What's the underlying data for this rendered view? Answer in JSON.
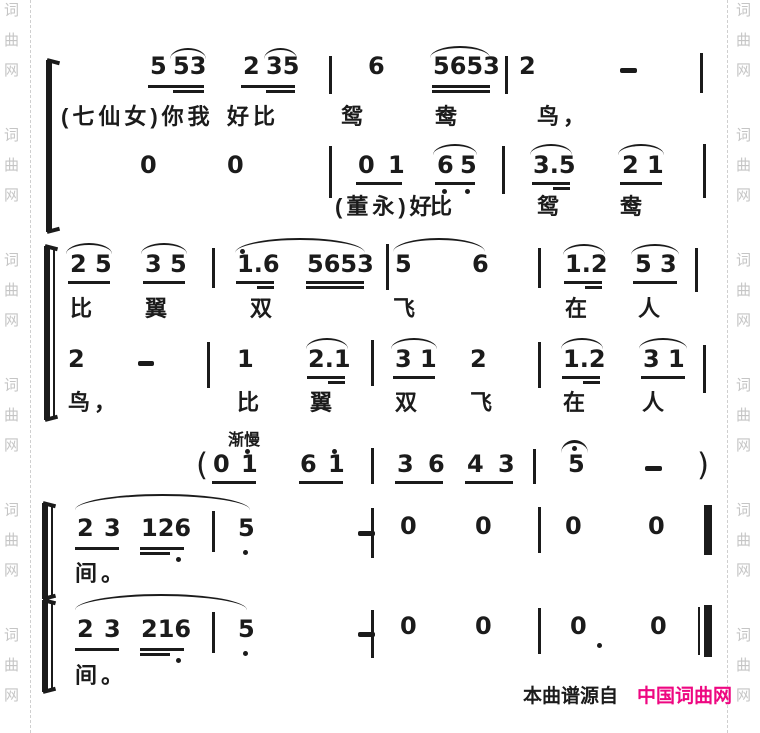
{
  "page": {
    "width": 760,
    "height": 733,
    "bg": "#ffffff",
    "ink": "#1b1b1b"
  },
  "watermark": {
    "chars": [
      "词",
      "曲",
      "网"
    ],
    "color": "#c5c5c5",
    "group_ys": [
      3,
      128,
      253,
      378,
      503,
      628
    ],
    "char_gap": 30,
    "left_x": 4,
    "right_x": 736,
    "divider_left_x": 30,
    "divider_right_x": 727
  },
  "credit": {
    "prefix": "本曲谱源自",
    "brand": "中国词曲网",
    "prefix_color": "#1b1b1b",
    "brand_color": "#ee0781",
    "prefix_x": 523,
    "brand_x": 637,
    "y": 686
  },
  "score": {
    "summary": [
      "5 53 2 35 | 6 5653 | 2 — |  (七仙女)你我好比鸳鸯鸟，",
      "0 0 | 01 65 | 3.5 21 |  (董永)好比鸳鸯",
      "25 35 | 1.6 5653 | 5 6 | 1.2 53 |  比翼双飞在人",
      "2 — | 1 2.1 | 31 2 | 1.2 31 |  鸟，比翼双飞在人",
      "渐慢 (01 61 | 36 43 | 5 — )",
      "23 126 | 5 — | 0 0 | 0 0 ‖  间。",
      "23 216 | 5 — | 0 0 | 0 0 ‖  间。"
    ],
    "elements": [
      {
        "t": "brace",
        "x": 46,
        "y": 60,
        "h": 172
      },
      {
        "t": "brace",
        "x": 44,
        "y": 246,
        "h": 174
      },
      {
        "t": "bar",
        "x": 53,
        "y": 248,
        "h": 170,
        "w": 2
      },
      {
        "t": "brace",
        "x": 42,
        "y": 503,
        "h": 96
      },
      {
        "t": "bar",
        "x": 51,
        "y": 505,
        "h": 92,
        "w": 2
      },
      {
        "t": "brace",
        "x": 42,
        "y": 600,
        "h": 92
      },
      {
        "t": "bar",
        "x": 51,
        "y": 602,
        "h": 88,
        "w": 2
      },
      {
        "t": "note",
        "x": 150,
        "y": 58,
        "text": "5"
      },
      {
        "t": "note",
        "x": 173,
        "y": 58,
        "text": "53"
      },
      {
        "t": "beam",
        "x": 148,
        "y": 85,
        "w": 56
      },
      {
        "t": "beam",
        "x": 173,
        "y": 90,
        "w": 31
      },
      {
        "t": "slur",
        "x": 170,
        "y": 48,
        "w": 36
      },
      {
        "t": "note",
        "x": 243,
        "y": 58,
        "text": "2"
      },
      {
        "t": "note",
        "x": 266,
        "y": 58,
        "text": "35"
      },
      {
        "t": "beam",
        "x": 241,
        "y": 85,
        "w": 54
      },
      {
        "t": "beam",
        "x": 266,
        "y": 90,
        "w": 29
      },
      {
        "t": "slur",
        "x": 264,
        "y": 48,
        "w": 33
      },
      {
        "t": "bar",
        "x": 329,
        "y": 56,
        "h": 38
      },
      {
        "t": "note",
        "x": 368,
        "y": 58,
        "text": "6"
      },
      {
        "t": "note",
        "x": 433,
        "y": 58,
        "text": "5653"
      },
      {
        "t": "beam",
        "x": 432,
        "y": 85,
        "w": 58
      },
      {
        "t": "beam",
        "x": 432,
        "y": 90,
        "w": 58
      },
      {
        "t": "slur",
        "x": 430,
        "y": 46,
        "w": 60,
        "h": 12
      },
      {
        "t": "bar",
        "x": 505,
        "y": 56,
        "h": 38
      },
      {
        "t": "note",
        "x": 519,
        "y": 58,
        "text": "2"
      },
      {
        "t": "dash",
        "x": 620,
        "y": 68,
        "w": 17
      },
      {
        "t": "bar",
        "x": 700,
        "y": 53,
        "h": 40
      },
      {
        "t": "lyric",
        "x": 61,
        "y": 105,
        "text": "(七仙女)你我"
      },
      {
        "t": "lyric",
        "x": 227,
        "y": 105,
        "text": "好比"
      },
      {
        "t": "lyric",
        "x": 341,
        "y": 105,
        "text": "鸳"
      },
      {
        "t": "lyric",
        "x": 435,
        "y": 105,
        "text": "鸯"
      },
      {
        "t": "lyric",
        "x": 537,
        "y": 105,
        "text": "鸟，"
      },
      {
        "t": "note",
        "x": 140,
        "y": 157,
        "text": "0"
      },
      {
        "t": "note",
        "x": 227,
        "y": 157,
        "text": "0"
      },
      {
        "t": "bar",
        "x": 329,
        "y": 146,
        "h": 52
      },
      {
        "t": "note",
        "x": 358,
        "y": 157,
        "text": "0"
      },
      {
        "t": "note",
        "x": 388,
        "y": 157,
        "text": "1"
      },
      {
        "t": "beam",
        "x": 356,
        "y": 182,
        "w": 46
      },
      {
        "t": "note",
        "x": 437,
        "y": 157,
        "text": "6"
      },
      {
        "t": "note",
        "x": 460,
        "y": 157,
        "text": "5"
      },
      {
        "t": "beam",
        "x": 435,
        "y": 182,
        "w": 40
      },
      {
        "t": "slur",
        "x": 433,
        "y": 144,
        "w": 44
      },
      {
        "t": "dot",
        "x": 442,
        "y": 189
      },
      {
        "t": "dot",
        "x": 465,
        "y": 189
      },
      {
        "t": "bar",
        "x": 502,
        "y": 146,
        "h": 48
      },
      {
        "t": "note",
        "x": 533,
        "y": 157,
        "text": "3.5"
      },
      {
        "t": "beam",
        "x": 532,
        "y": 182,
        "w": 38
      },
      {
        "t": "beam",
        "x": 553,
        "y": 187,
        "w": 17
      },
      {
        "t": "slur",
        "x": 530,
        "y": 144,
        "w": 42
      },
      {
        "t": "note",
        "x": 622,
        "y": 157,
        "text": "2"
      },
      {
        "t": "note",
        "x": 647,
        "y": 157,
        "text": "1"
      },
      {
        "t": "beam",
        "x": 620,
        "y": 182,
        "w": 42
      },
      {
        "t": "slur",
        "x": 618,
        "y": 144,
        "w": 46
      },
      {
        "t": "bar",
        "x": 703,
        "y": 144,
        "h": 54
      },
      {
        "t": "lyric",
        "x": 335,
        "y": 195,
        "text": "(董永)好"
      },
      {
        "t": "lyric",
        "x": 430,
        "y": 195,
        "text": "比"
      },
      {
        "t": "lyric",
        "x": 537,
        "y": 195,
        "text": "鸳"
      },
      {
        "t": "lyric",
        "x": 620,
        "y": 195,
        "text": "鸯"
      },
      {
        "t": "note",
        "x": 70,
        "y": 256,
        "text": "2"
      },
      {
        "t": "note",
        "x": 95,
        "y": 256,
        "text": "5"
      },
      {
        "t": "beam",
        "x": 68,
        "y": 281,
        "w": 42
      },
      {
        "t": "slur",
        "x": 66,
        "y": 243,
        "w": 46
      },
      {
        "t": "note",
        "x": 145,
        "y": 256,
        "text": "3"
      },
      {
        "t": "note",
        "x": 170,
        "y": 256,
        "text": "5"
      },
      {
        "t": "beam",
        "x": 143,
        "y": 281,
        "w": 42
      },
      {
        "t": "slur",
        "x": 141,
        "y": 243,
        "w": 46
      },
      {
        "t": "bar",
        "x": 212,
        "y": 248,
        "h": 40
      },
      {
        "t": "note",
        "x": 237,
        "y": 256,
        "text": "1.6"
      },
      {
        "t": "dot",
        "x": 240,
        "y": 249
      },
      {
        "t": "beam",
        "x": 236,
        "y": 281,
        "w": 38
      },
      {
        "t": "beam",
        "x": 257,
        "y": 286,
        "w": 17
      },
      {
        "t": "note",
        "x": 307,
        "y": 256,
        "text": "5653"
      },
      {
        "t": "beam",
        "x": 306,
        "y": 281,
        "w": 58
      },
      {
        "t": "beam",
        "x": 306,
        "y": 286,
        "w": 58
      },
      {
        "t": "slur",
        "x": 235,
        "y": 238,
        "w": 130,
        "h": 15
      },
      {
        "t": "bar",
        "x": 386,
        "y": 244,
        "h": 46
      },
      {
        "t": "note",
        "x": 395,
        "y": 256,
        "text": "5"
      },
      {
        "t": "note",
        "x": 472,
        "y": 256,
        "text": "6"
      },
      {
        "t": "slur",
        "x": 393,
        "y": 238,
        "w": 92,
        "h": 14
      },
      {
        "t": "bar",
        "x": 538,
        "y": 248,
        "h": 40
      },
      {
        "t": "note",
        "x": 565,
        "y": 256,
        "text": "1.2"
      },
      {
        "t": "beam",
        "x": 564,
        "y": 281,
        "w": 38
      },
      {
        "t": "beam",
        "x": 585,
        "y": 286,
        "w": 17
      },
      {
        "t": "slur",
        "x": 563,
        "y": 244,
        "w": 42
      },
      {
        "t": "note",
        "x": 635,
        "y": 256,
        "text": "5"
      },
      {
        "t": "note",
        "x": 660,
        "y": 256,
        "text": "3"
      },
      {
        "t": "beam",
        "x": 633,
        "y": 281,
        "w": 44
      },
      {
        "t": "slur",
        "x": 631,
        "y": 244,
        "w": 48
      },
      {
        "t": "bar",
        "x": 695,
        "y": 248,
        "h": 44
      },
      {
        "t": "lyric",
        "x": 70,
        "y": 297,
        "text": "比"
      },
      {
        "t": "lyric",
        "x": 145,
        "y": 297,
        "text": "翼"
      },
      {
        "t": "lyric",
        "x": 250,
        "y": 297,
        "text": "双"
      },
      {
        "t": "lyric",
        "x": 393,
        "y": 297,
        "text": "飞"
      },
      {
        "t": "lyric",
        "x": 565,
        "y": 297,
        "text": "在"
      },
      {
        "t": "lyric",
        "x": 638,
        "y": 297,
        "text": "人"
      },
      {
        "t": "note",
        "x": 68,
        "y": 351,
        "text": "2"
      },
      {
        "t": "dash",
        "x": 138,
        "y": 361,
        "w": 16
      },
      {
        "t": "bar",
        "x": 207,
        "y": 342,
        "h": 46
      },
      {
        "t": "note",
        "x": 237,
        "y": 351,
        "text": "1"
      },
      {
        "t": "note",
        "x": 308,
        "y": 351,
        "text": "2.1"
      },
      {
        "t": "beam",
        "x": 307,
        "y": 376,
        "w": 38
      },
      {
        "t": "beam",
        "x": 328,
        "y": 381,
        "w": 17
      },
      {
        "t": "slur",
        "x": 306,
        "y": 338,
        "w": 42
      },
      {
        "t": "bar",
        "x": 371,
        "y": 340,
        "h": 46
      },
      {
        "t": "note",
        "x": 395,
        "y": 351,
        "text": "3"
      },
      {
        "t": "note",
        "x": 420,
        "y": 351,
        "text": "1"
      },
      {
        "t": "beam",
        "x": 393,
        "y": 376,
        "w": 42
      },
      {
        "t": "slur",
        "x": 391,
        "y": 338,
        "w": 46
      },
      {
        "t": "note",
        "x": 470,
        "y": 351,
        "text": "2"
      },
      {
        "t": "bar",
        "x": 538,
        "y": 342,
        "h": 46
      },
      {
        "t": "note",
        "x": 563,
        "y": 351,
        "text": "1.2"
      },
      {
        "t": "beam",
        "x": 562,
        "y": 376,
        "w": 38
      },
      {
        "t": "beam",
        "x": 583,
        "y": 381,
        "w": 17
      },
      {
        "t": "slur",
        "x": 561,
        "y": 338,
        "w": 42
      },
      {
        "t": "note",
        "x": 643,
        "y": 351,
        "text": "3"
      },
      {
        "t": "note",
        "x": 668,
        "y": 351,
        "text": "1"
      },
      {
        "t": "beam",
        "x": 641,
        "y": 376,
        "w": 44
      },
      {
        "t": "slur",
        "x": 639,
        "y": 338,
        "w": 48
      },
      {
        "t": "bar",
        "x": 703,
        "y": 345,
        "h": 48
      },
      {
        "t": "lyric",
        "x": 68,
        "y": 391,
        "text": "鸟，"
      },
      {
        "t": "lyric",
        "x": 237,
        "y": 391,
        "text": "比"
      },
      {
        "t": "lyric",
        "x": 310,
        "y": 391,
        "text": "翼"
      },
      {
        "t": "lyric",
        "x": 395,
        "y": 391,
        "text": "双"
      },
      {
        "t": "lyric",
        "x": 470,
        "y": 391,
        "text": "飞"
      },
      {
        "t": "lyric",
        "x": 563,
        "y": 391,
        "text": "在"
      },
      {
        "t": "lyric",
        "x": 642,
        "y": 391,
        "text": "人"
      },
      {
        "t": "label",
        "x": 228,
        "y": 433,
        "text": "渐慢"
      },
      {
        "t": "paren",
        "x": 196,
        "y": 450,
        "text": "("
      },
      {
        "t": "note",
        "x": 213,
        "y": 456,
        "text": "0"
      },
      {
        "t": "note",
        "x": 241,
        "y": 456,
        "text": "1"
      },
      {
        "t": "dot",
        "x": 245,
        "y": 449
      },
      {
        "t": "beam",
        "x": 212,
        "y": 481,
        "w": 44
      },
      {
        "t": "note",
        "x": 300,
        "y": 456,
        "text": "6"
      },
      {
        "t": "note",
        "x": 328,
        "y": 456,
        "text": "1"
      },
      {
        "t": "dot",
        "x": 332,
        "y": 449
      },
      {
        "t": "beam",
        "x": 299,
        "y": 481,
        "w": 44
      },
      {
        "t": "bar",
        "x": 371,
        "y": 448,
        "h": 36
      },
      {
        "t": "note",
        "x": 397,
        "y": 456,
        "text": "3"
      },
      {
        "t": "note",
        "x": 428,
        "y": 456,
        "text": "6"
      },
      {
        "t": "beam",
        "x": 395,
        "y": 481,
        "w": 48
      },
      {
        "t": "note",
        "x": 467,
        "y": 456,
        "text": "4"
      },
      {
        "t": "note",
        "x": 498,
        "y": 456,
        "text": "3"
      },
      {
        "t": "beam",
        "x": 465,
        "y": 481,
        "w": 48
      },
      {
        "t": "bar",
        "x": 533,
        "y": 449,
        "h": 35
      },
      {
        "t": "fermata",
        "x": 561,
        "y": 440,
        "w": 27
      },
      {
        "t": "note",
        "x": 568,
        "y": 456,
        "text": "5"
      },
      {
        "t": "dash",
        "x": 645,
        "y": 466,
        "w": 17
      },
      {
        "t": "paren",
        "x": 697,
        "y": 450,
        "text": ")"
      },
      {
        "t": "slur",
        "x": 75,
        "y": 494,
        "w": 175,
        "h": 16
      },
      {
        "t": "note",
        "x": 77,
        "y": 520,
        "text": "2"
      },
      {
        "t": "note",
        "x": 104,
        "y": 520,
        "text": "3"
      },
      {
        "t": "beam",
        "x": 75,
        "y": 547,
        "w": 44
      },
      {
        "t": "note",
        "x": 141,
        "y": 520,
        "text": "126"
      },
      {
        "t": "beam",
        "x": 140,
        "y": 547,
        "w": 44
      },
      {
        "t": "beam",
        "x": 140,
        "y": 552,
        "w": 30
      },
      {
        "t": "dot",
        "x": 176,
        "y": 557
      },
      {
        "t": "bar",
        "x": 212,
        "y": 511,
        "h": 41
      },
      {
        "t": "note",
        "x": 238,
        "y": 520,
        "text": "5"
      },
      {
        "t": "dot",
        "x": 243,
        "y": 550
      },
      {
        "t": "dash",
        "x": 358,
        "y": 531,
        "w": 17
      },
      {
        "t": "bar",
        "x": 371,
        "y": 508,
        "h": 50
      },
      {
        "t": "note",
        "x": 400,
        "y": 518,
        "text": "0"
      },
      {
        "t": "note",
        "x": 475,
        "y": 518,
        "text": "0"
      },
      {
        "t": "bar",
        "x": 538,
        "y": 507,
        "h": 46
      },
      {
        "t": "note",
        "x": 565,
        "y": 518,
        "text": "0"
      },
      {
        "t": "note",
        "x": 648,
        "y": 518,
        "text": "0"
      },
      {
        "t": "thick",
        "x": 704,
        "y": 505,
        "h": 50
      },
      {
        "t": "lyric",
        "x": 75,
        "y": 562,
        "text": "间。"
      },
      {
        "t": "slur",
        "x": 75,
        "y": 594,
        "w": 172,
        "h": 16
      },
      {
        "t": "note",
        "x": 77,
        "y": 621,
        "text": "2"
      },
      {
        "t": "note",
        "x": 104,
        "y": 621,
        "text": "3"
      },
      {
        "t": "beam",
        "x": 75,
        "y": 648,
        "w": 44
      },
      {
        "t": "note",
        "x": 141,
        "y": 621,
        "text": "216"
      },
      {
        "t": "beam",
        "x": 140,
        "y": 648,
        "w": 44
      },
      {
        "t": "beam",
        "x": 140,
        "y": 653,
        "w": 30
      },
      {
        "t": "dot",
        "x": 176,
        "y": 658
      },
      {
        "t": "bar",
        "x": 212,
        "y": 612,
        "h": 41
      },
      {
        "t": "note",
        "x": 238,
        "y": 621,
        "text": "5"
      },
      {
        "t": "dot",
        "x": 243,
        "y": 651
      },
      {
        "t": "dash",
        "x": 358,
        "y": 632,
        "w": 17
      },
      {
        "t": "bar",
        "x": 371,
        "y": 610,
        "h": 48
      },
      {
        "t": "note",
        "x": 400,
        "y": 618,
        "text": "0"
      },
      {
        "t": "note",
        "x": 475,
        "y": 618,
        "text": "0"
      },
      {
        "t": "bar",
        "x": 538,
        "y": 608,
        "h": 46
      },
      {
        "t": "note",
        "x": 570,
        "y": 618,
        "text": "0"
      },
      {
        "t": "dot",
        "x": 597,
        "y": 643
      },
      {
        "t": "note",
        "x": 650,
        "y": 618,
        "text": "0"
      },
      {
        "t": "bar",
        "x": 698,
        "y": 607,
        "h": 48,
        "w": 2
      },
      {
        "t": "thick",
        "x": 704,
        "y": 605,
        "h": 52
      },
      {
        "t": "lyric",
        "x": 75,
        "y": 664,
        "text": "间。"
      }
    ]
  }
}
